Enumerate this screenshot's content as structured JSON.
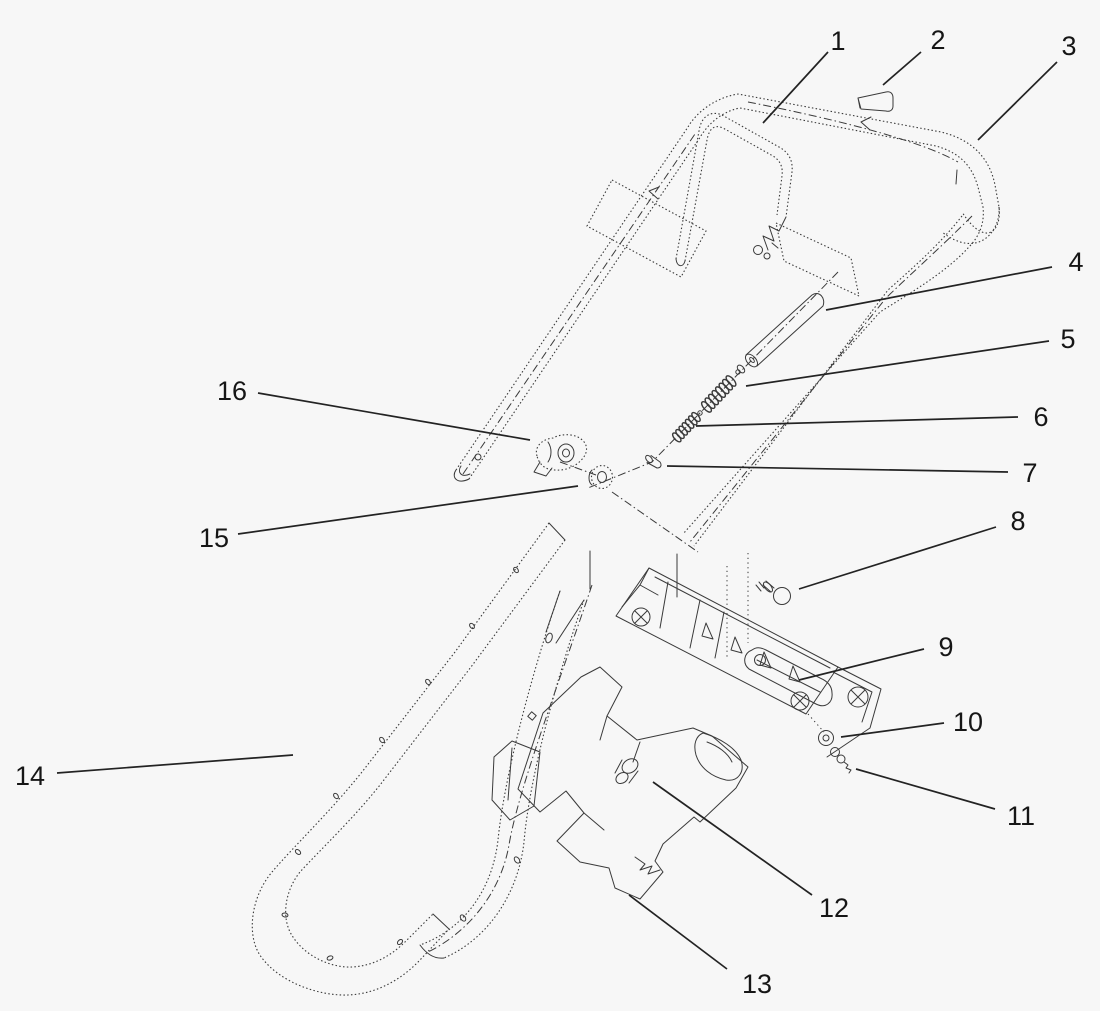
{
  "figure": {
    "kind": "exploded-parts-diagram",
    "description": "Exploded view line drawing of a handle and control-housing assembly with 16 numbered callouts",
    "background": "#f7f7f7",
    "line_color": "#3a3a3a",
    "leader_color": "#232323",
    "label_color": "#161616",
    "label_font_size": 27,
    "canvas": {
      "width": 1100,
      "height": 1011
    }
  },
  "callouts": [
    {
      "num": "1",
      "lx": 838,
      "ly": 41,
      "x1": 828,
      "y1": 52,
      "x2": 763,
      "y2": 123
    },
    {
      "num": "2",
      "lx": 938,
      "ly": 40,
      "x1": 921,
      "y1": 52,
      "x2": 883,
      "y2": 85
    },
    {
      "num": "3",
      "lx": 1069,
      "ly": 46,
      "x1": 1057,
      "y1": 62,
      "x2": 978,
      "y2": 140
    },
    {
      "num": "4",
      "lx": 1076,
      "ly": 262,
      "x1": 1052,
      "y1": 267,
      "x2": 826,
      "y2": 310
    },
    {
      "num": "5",
      "lx": 1068,
      "ly": 339,
      "x1": 1049,
      "y1": 341,
      "x2": 746,
      "y2": 386
    },
    {
      "num": "6",
      "lx": 1041,
      "ly": 417,
      "x1": 1018,
      "y1": 417,
      "x2": 696,
      "y2": 426
    },
    {
      "num": "7",
      "lx": 1030,
      "ly": 473,
      "x1": 1008,
      "y1": 472,
      "x2": 667,
      "y2": 466
    },
    {
      "num": "8",
      "lx": 1018,
      "ly": 521,
      "x1": 996,
      "y1": 527,
      "x2": 799,
      "y2": 589
    },
    {
      "num": "9",
      "lx": 946,
      "ly": 647,
      "x1": 924,
      "y1": 649,
      "x2": 799,
      "y2": 680
    },
    {
      "num": "10",
      "lx": 968,
      "ly": 722,
      "x1": 944,
      "y1": 723,
      "x2": 841,
      "y2": 737
    },
    {
      "num": "11",
      "lx": 1021,
      "ly": 816,
      "x1": 995,
      "y1": 809,
      "x2": 856,
      "y2": 769
    },
    {
      "num": "12",
      "lx": 834,
      "ly": 908,
      "x1": 812,
      "y1": 895,
      "x2": 653,
      "y2": 782
    },
    {
      "num": "13",
      "lx": 757,
      "ly": 984,
      "x1": 727,
      "y1": 969,
      "x2": 629,
      "y2": 895
    },
    {
      "num": "14",
      "lx": 30,
      "ly": 776,
      "x1": 57,
      "y1": 773,
      "x2": 293,
      "y2": 755
    },
    {
      "num": "15",
      "lx": 214,
      "ly": 538,
      "x1": 238,
      "y1": 534,
      "x2": 578,
      "y2": 486
    },
    {
      "num": "16",
      "lx": 232,
      "ly": 391,
      "x1": 258,
      "y1": 393,
      "x2": 530,
      "y2": 440
    }
  ]
}
